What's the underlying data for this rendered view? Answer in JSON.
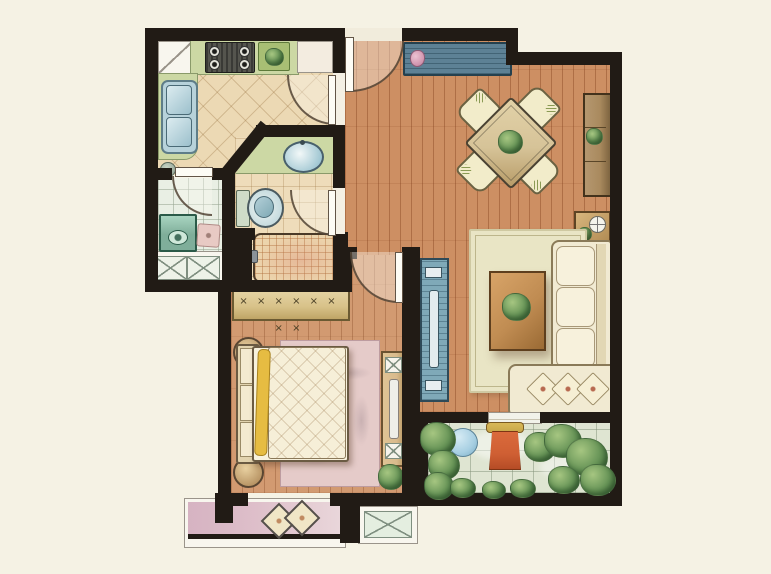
{
  "colors": {
    "background": "#f5f2e4",
    "wall": "#211b15",
    "wood_living": "#cd8f63",
    "wood_bedroom": "#d29a71",
    "tile_kitchen": "#ecd9b4",
    "tile_bath": "#eedcba",
    "tile_utility": "#e9efe4",
    "tile_balcony": "#dfe5d2",
    "counter_green": "#ccd8a4",
    "sink_steel": "#b7d2da",
    "sideboard_teal": "#5d8195",
    "tv_stand_teal": "#7fa9b8",
    "dining_wood": "#d6c398",
    "chair_cream": "#f2ecca",
    "rug_living": "#e9e5c5",
    "rug_bedroom": "#e5cbc9",
    "sofa_cream": "#f1ead2",
    "quilt_cream": "#f6efd8",
    "wardrobe_tan": "#d8c289",
    "bay_pink": "#debfca",
    "plant_green": "#679457",
    "plant_dark": "#46703f",
    "chair_orange": "#cf5f33",
    "table_blue": "#a7cfe2",
    "cabinet_brown": "#a98a5e",
    "wood_coffee": "#c08c52",
    "yellow_throw": "#e6bc42"
  },
  "rooms": [
    "kitchen",
    "laundry-room",
    "bathroom",
    "entry-hall",
    "living-dining-room",
    "bedroom",
    "balcony"
  ],
  "furniture": {
    "kitchen": [
      "corner-cabinet",
      "gas-stove",
      "prep-plate",
      "refrigerator",
      "double-sink",
      "waste-bin"
    ],
    "laundry_room": [
      "washing-machine",
      "floor-drain",
      "bay-window",
      "glass-door"
    ],
    "bathroom": [
      "vanity-counter",
      "wash-basin",
      "toilet",
      "shower-tray"
    ],
    "entry_hall": [
      "entry-door",
      "shoe-sideboard"
    ],
    "living_dining_room": [
      "dining-table",
      "dining-chairs",
      "tall-cabinet",
      "side-table",
      "tv-cabinet",
      "area-rug",
      "coffee-table",
      "corner-sofa",
      "balcony-threshold"
    ],
    "bedroom": [
      "wardrobe",
      "double-bed",
      "nightstand-stools",
      "area-rug",
      "tv-dresser",
      "potted-plant",
      "bay-window-seat",
      "cushions",
      "ac-platform"
    ],
    "balcony": [
      "round-table",
      "lounge-chair",
      "plants"
    ]
  },
  "bedroom": {
    "wardrobe_hanger_glyphs": "× × × × × × × ×"
  }
}
